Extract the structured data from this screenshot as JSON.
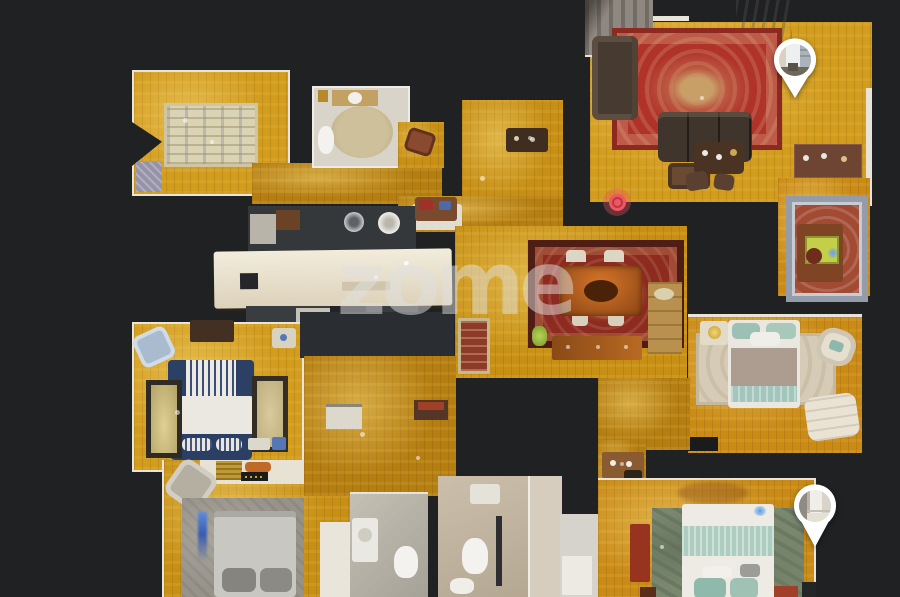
{
  "app": {
    "name": "3D dollhouse virtual tour viewer",
    "watermark": "zome"
  },
  "theme": {
    "background": "#1f2123",
    "wall": "#2a2d31",
    "floor": "#c79015",
    "accent": "#ee5560",
    "pin": "#ffffff"
  },
  "markers": {
    "pano_pins": [
      {
        "name": "pano-pin-living-room",
        "preview": "sunlit room with windows"
      },
      {
        "name": "pano-pin-bedroom",
        "preview": "white doorway"
      }
    ],
    "position_dot": {
      "name": "current-position-dot",
      "color": "#ee5560"
    }
  }
}
